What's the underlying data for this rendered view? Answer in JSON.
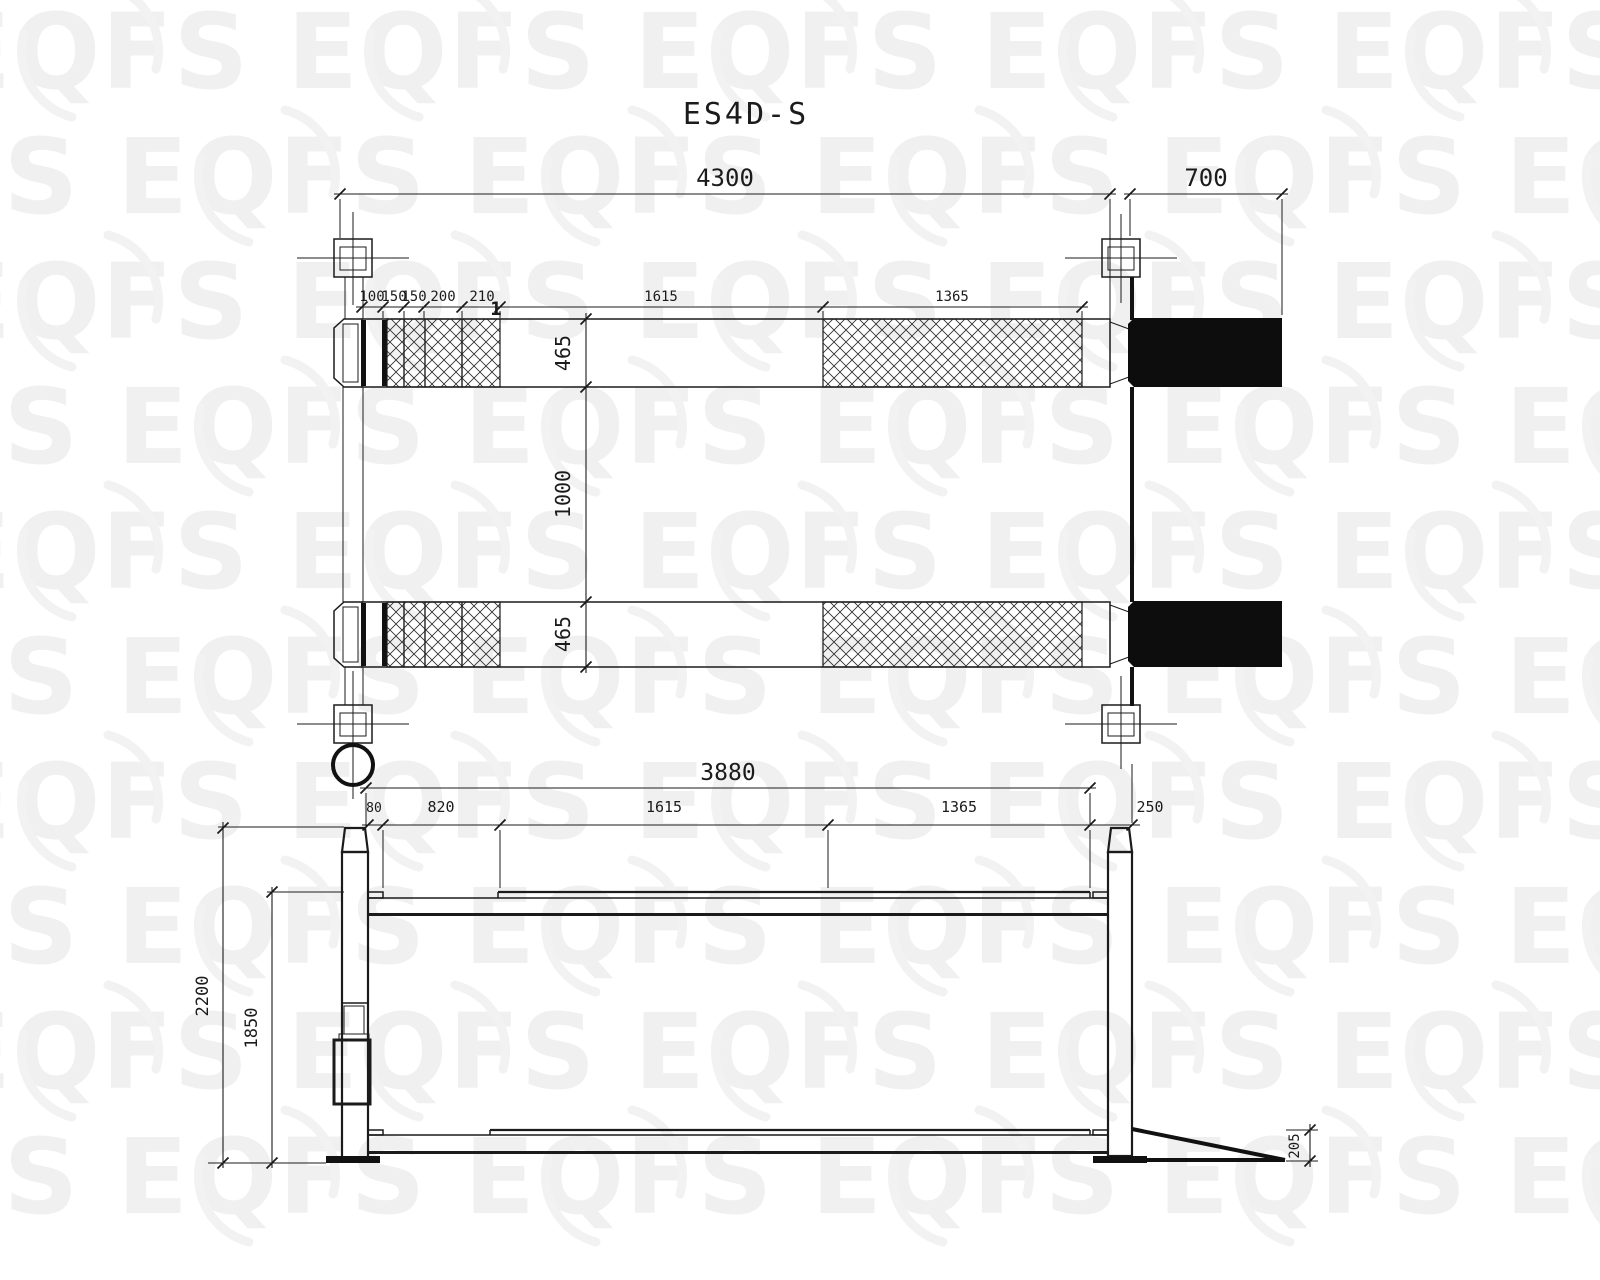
{
  "watermark": {
    "text": "EQFS"
  },
  "drawing": {
    "title": "ES4D-S"
  },
  "top_view": {
    "overall_length": "4300",
    "ramp_length": "700",
    "front_segments": [
      "100",
      "150",
      "150",
      "200",
      "210"
    ],
    "mid_length": "1615",
    "rear_length": "1365",
    "runway_width_front": "465",
    "runway_gap": "1000",
    "runway_width_rear": "465",
    "section_callout": "1"
  },
  "side_view": {
    "overall_length": "3880",
    "seg_1": "80",
    "seg_2": "820",
    "seg_3": "1615",
    "seg_4": "1365",
    "seg_5": "250",
    "overall_height": "2200",
    "platform_height": "1850",
    "ramp_height": "205"
  }
}
